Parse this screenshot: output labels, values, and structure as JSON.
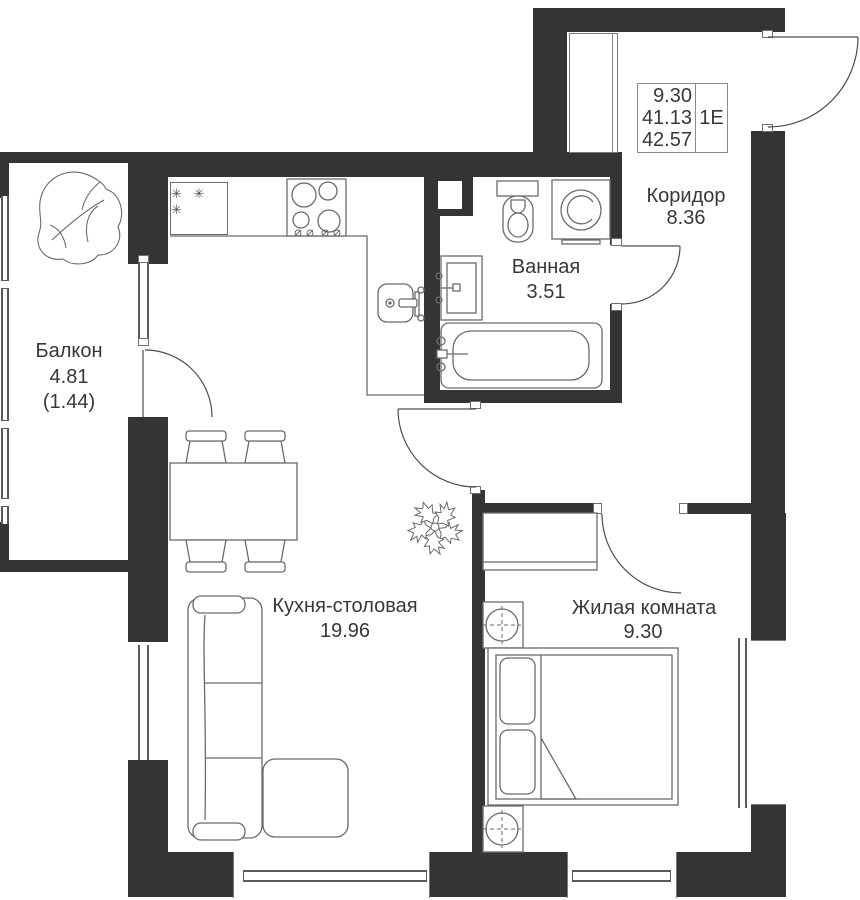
{
  "info_box": {
    "value_top": "9.30",
    "value_mid": "41.13",
    "value_bottom": "42.57",
    "unit_type": "1Е"
  },
  "rooms": {
    "balcony": {
      "name": "Балкон",
      "area": "4.81",
      "area_secondary": "(1.44)"
    },
    "kitchen_dining": {
      "name": "Кухня-столовая",
      "area": "19.96"
    },
    "bathroom": {
      "name": "Ванная",
      "area": "3.51"
    },
    "corridor": {
      "name": "Коридор",
      "area": "8.36"
    },
    "living_room": {
      "name": "Жилая комната",
      "area": "9.30"
    }
  },
  "symbols": {
    "fridge_freezer": "✳ ✳ ✳"
  },
  "colors": {
    "wall": "#343434",
    "furniture_line": "#6b6b6b",
    "text": "#383838"
  }
}
